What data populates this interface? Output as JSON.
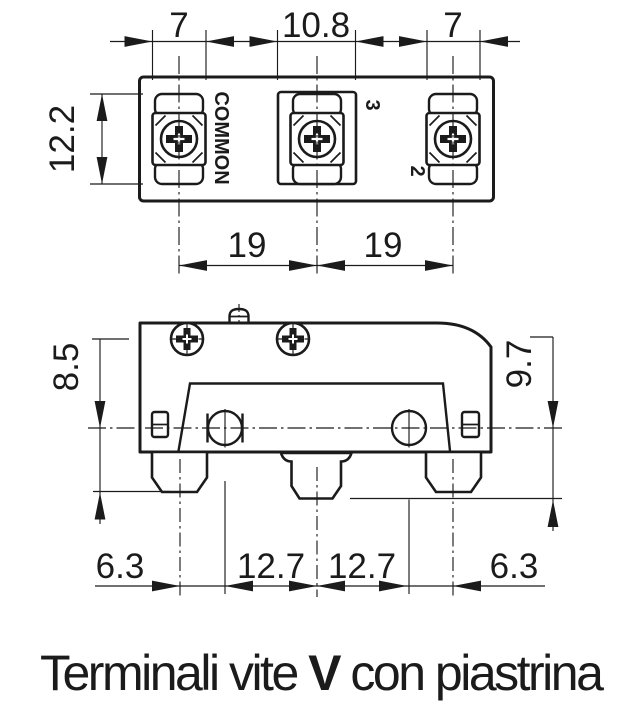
{
  "caption": {
    "part1": "Terminali vite ",
    "bold": "V",
    "part2": " con piastrina"
  },
  "top_view": {
    "labels": {
      "common": "COMMON",
      "terminal_3": "3",
      "terminal_2": "2"
    },
    "dims": {
      "w_left": "7",
      "w_mid": "10.8",
      "w_right": "7",
      "height": "12.2",
      "pitch_l": "19",
      "pitch_r": "19"
    }
  },
  "side_view": {
    "dims": {
      "h_left": "8.5",
      "h_right": "9.7",
      "off_l": "6.3",
      "p_l": "12.7",
      "p_r": "12.7",
      "off_r": "6.3"
    }
  },
  "colors": {
    "line": "#1b1b1b",
    "background": "#ffffff"
  }
}
